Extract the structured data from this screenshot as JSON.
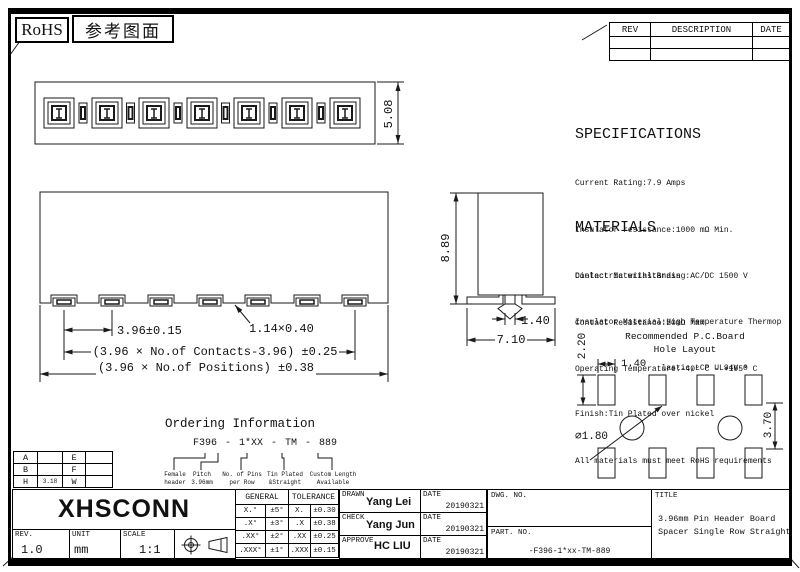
{
  "header": {
    "rohs_badge": "RoHS",
    "reference_badge": "参考图面"
  },
  "rev_table": {
    "headers": [
      "REV",
      "DESCRIPTION",
      "DATE"
    ],
    "rows": [
      [
        "",
        "",
        ""
      ],
      [
        "",
        "",
        ""
      ]
    ]
  },
  "top_view": {
    "height_dim": "5.08"
  },
  "front_view": {
    "pitch_dim": "3.96±0.15",
    "pin_dim": "1.14×0.40",
    "contacts_dim": "(3.96 × No.of Contacts-3.96) ±0.25",
    "positions_dim": "(3.96 × No.of Positions) ±0.38"
  },
  "side_view": {
    "height_dim": "8.89",
    "peg_dim": "1.40",
    "width_dim": "7.10"
  },
  "specifications": {
    "title": "SPECIFICATIONS",
    "lines": [
      "Current Rating:7.9 Amps",
      "Insulator resistance:1000 mΩ Min.",
      "Dielectric withstanding:AC/DC 1500 V",
      "Contact Resistance:20mΩ Max",
      "Operating Temperature:-40° C - +105° C"
    ]
  },
  "materials": {
    "title": "MATERIALS",
    "lines": [
      "Contact Material:Brass",
      "Insulator Material:High Temperature Thermop",
      "                  lastic,LCP UL94V-0",
      "Finish:Tin Plated over nickel",
      "All materials must meet RoHS requirements"
    ]
  },
  "pcb_layout": {
    "title_line1": "Recommended P.C.Board",
    "title_line2": "Hole Layout",
    "vertical_dim": "2.20",
    "hole_width_dim": "1.40",
    "diameter_dim": "∅1.80",
    "row_spacing_dim": "3.70"
  },
  "ordering": {
    "title": "Ordering Information",
    "part_number": "F396 - 1*XX - TM - 889",
    "legend": [
      {
        "line1": "Female",
        "line2": "header"
      },
      {
        "line1": "Pitch",
        "line2": "3.96mm"
      },
      {
        "line1": "No. of Pins",
        "line2": "per Row"
      },
      {
        "line1": "Tin Plated",
        "line2": "&Straight"
      },
      {
        "line1": "Custom Length",
        "line2": "Available"
      }
    ]
  },
  "dim_table": {
    "rows": [
      {
        "c0": "A",
        "c1": "",
        "c2": "E",
        "c3": ""
      },
      {
        "c0": "B",
        "c1": "",
        "c2": "F",
        "c3": ""
      },
      {
        "c0": "H",
        "c1": "3.18",
        "c2": "W",
        "c3": ""
      }
    ]
  },
  "title_block": {
    "logo": "XHSCONN",
    "rev": {
      "label": "REV.",
      "value": "1.0"
    },
    "unit": {
      "label": "UNIT",
      "value": "mm"
    },
    "scale": {
      "label": "SCALE",
      "value": "1:1"
    },
    "tolerance": {
      "header_left": "GENERAL",
      "header_right": "TOLERANCE",
      "rows": [
        {
          "a": "X.°",
          "b": "±5°",
          "c": "X.",
          "d": "±0.30"
        },
        {
          "a": ".X°",
          "b": "±3°",
          "c": ".X",
          "d": "±0.38"
        },
        {
          "a": ".XX°",
          "b": "±2°",
          "c": ".XX",
          "d": "±0.25"
        },
        {
          "a": ".XXX°",
          "b": "±1°",
          "c": ".XXX",
          "d": "±0.15"
        }
      ]
    },
    "signoff": {
      "rows": [
        {
          "role": "DRAWN",
          "name": "Yang Lei",
          "date_label": "DATE",
          "date": "20190321"
        },
        {
          "role": "CHECK",
          "name": "Yang Jun",
          "date_label": "DATE",
          "date": "20190321"
        },
        {
          "role": "APPROVE",
          "name": "HC LIU",
          "date_label": "DATE",
          "date": "20190321"
        }
      ]
    },
    "dwg_no_label": "DWG. NO.",
    "part_no_label": "PART. NO.",
    "part_no_value": "-F396-1*xx-TM-889",
    "title_label": "TITLE",
    "title_line1": "3.96mm Pin Header Board",
    "title_line2": "Spacer Single Row Straight"
  }
}
